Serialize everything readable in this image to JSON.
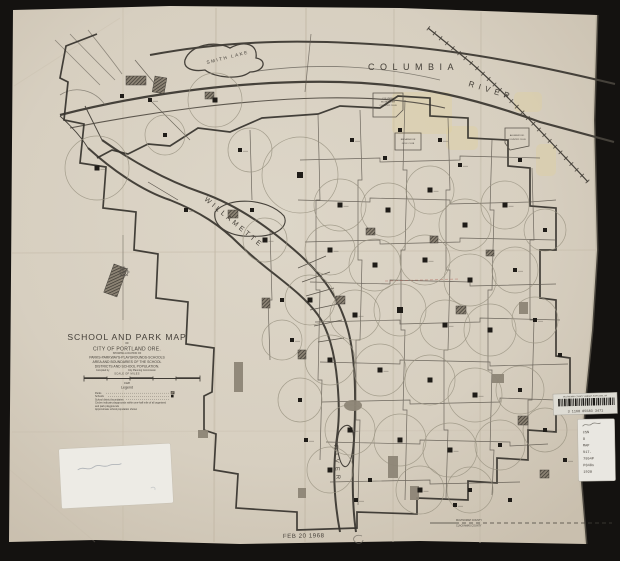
{
  "canvas": {
    "width": 620,
    "height": 561,
    "bg": "#141210",
    "paper": "#d8d0c2",
    "ink": "#433e37"
  },
  "map_labels": {
    "columbia": "COLUMBIA",
    "columbia_river": "RIVER",
    "smith_lake": "SMITH  LAKE",
    "willamette": "WILLAMETTE",
    "willamette_river": "RIVER",
    "club1": [
      "COLUMBIA",
      "EDGEWATER",
      "COUNTRY CLUB"
    ],
    "club2": [
      "BROADMOOR",
      "GOLF CLUB"
    ],
    "club3": [
      "ALDERWOOD",
      "COUNTRY CLUB"
    ],
    "county_top": "MULTNOMAH COUNTY",
    "county_bottom": "CLACKAMAS COUNTY"
  },
  "title_block": {
    "title": "SCHOOL AND PARK MAP",
    "of": "OF",
    "city": "CITY OF PORTLAND ORE.",
    "showing": "SHOWING LOCATION OF",
    "line1": "PARKS-PARKWAYS-PLAYGROUNDS-SCHOOLS",
    "line2": "AREA AND BOUNDARIES OF THE SCHOOL",
    "line3": "DISTRICTS AND SCHOOL POPULATION.",
    "compiled_by": "Compiled by",
    "commission": "City Planning Commission",
    "scale_caption": "SCALE OF MILES",
    "year": "1928",
    "legend_heading": "Legend",
    "legend_entries": [
      "Parks",
      "Schools",
      "School district boundaries",
      "Circles indicate playgrounds within one-half mile of all organized",
      "and park playgrounds",
      "Approximate school population shown"
    ]
  },
  "stamps": {
    "date": "FEB 20 1968"
  },
  "library": {
    "barcode_header": "MULTNOMAH COUNTY LIBRARY, PORTLAND, OR",
    "barcode_number": "3 1168 05583 3471",
    "call_lines": [
      "CSN",
      "O",
      "MAP",
      "917.",
      "7954P",
      "P848s",
      "1928"
    ]
  },
  "features": {
    "schools": [
      [
        97,
        168,
        5
      ],
      [
        122,
        96,
        4
      ],
      [
        150,
        100,
        4
      ],
      [
        165,
        135,
        4
      ],
      [
        186,
        210,
        4
      ],
      [
        215,
        100,
        5
      ],
      [
        240,
        150,
        4
      ],
      [
        252,
        210,
        4
      ],
      [
        265,
        240,
        5
      ],
      [
        282,
        300,
        4
      ],
      [
        292,
        340,
        4
      ],
      [
        300,
        400,
        4
      ],
      [
        306,
        440,
        4
      ],
      [
        330,
        470,
        5
      ],
      [
        356,
        500,
        4
      ],
      [
        300,
        175,
        6
      ],
      [
        340,
        205,
        5
      ],
      [
        388,
        210,
        5
      ],
      [
        430,
        190,
        5
      ],
      [
        465,
        225,
        5
      ],
      [
        505,
        205,
        5
      ],
      [
        545,
        230,
        4
      ],
      [
        330,
        250,
        5
      ],
      [
        375,
        265,
        5
      ],
      [
        425,
        260,
        5
      ],
      [
        470,
        280,
        5
      ],
      [
        515,
        270,
        4
      ],
      [
        310,
        300,
        5
      ],
      [
        355,
        315,
        5
      ],
      [
        400,
        310,
        6
      ],
      [
        445,
        325,
        5
      ],
      [
        490,
        330,
        5
      ],
      [
        535,
        320,
        4
      ],
      [
        330,
        360,
        5
      ],
      [
        380,
        370,
        5
      ],
      [
        430,
        380,
        5
      ],
      [
        475,
        395,
        5
      ],
      [
        520,
        390,
        4
      ],
      [
        350,
        430,
        5
      ],
      [
        400,
        440,
        5
      ],
      [
        450,
        450,
        5
      ],
      [
        500,
        445,
        4
      ],
      [
        545,
        430,
        4
      ],
      [
        370,
        480,
        4
      ],
      [
        420,
        490,
        5
      ],
      [
        470,
        490,
        4
      ],
      [
        440,
        140,
        4
      ],
      [
        400,
        130,
        4
      ],
      [
        352,
        140,
        4
      ],
      [
        560,
        355,
        4
      ],
      [
        565,
        460,
        4
      ],
      [
        510,
        500,
        4
      ],
      [
        455,
        505,
        4
      ],
      [
        385,
        158,
        4
      ],
      [
        460,
        165,
        4
      ],
      [
        520,
        160,
        4
      ]
    ],
    "circles": [
      [
        97,
        168,
        32
      ],
      [
        215,
        100,
        27
      ],
      [
        165,
        135,
        20
      ],
      [
        300,
        175,
        38
      ],
      [
        250,
        150,
        22
      ],
      [
        340,
        205,
        26
      ],
      [
        388,
        210,
        27
      ],
      [
        430,
        190,
        24
      ],
      [
        465,
        225,
        26
      ],
      [
        505,
        205,
        24
      ],
      [
        545,
        230,
        21
      ],
      [
        330,
        250,
        25
      ],
      [
        375,
        265,
        26
      ],
      [
        425,
        260,
        25
      ],
      [
        470,
        280,
        26
      ],
      [
        515,
        270,
        23
      ],
      [
        310,
        300,
        25
      ],
      [
        355,
        315,
        25
      ],
      [
        400,
        310,
        26
      ],
      [
        445,
        325,
        25
      ],
      [
        490,
        330,
        26
      ],
      [
        535,
        320,
        23
      ],
      [
        330,
        360,
        25
      ],
      [
        380,
        370,
        26
      ],
      [
        430,
        380,
        25
      ],
      [
        475,
        395,
        27
      ],
      [
        520,
        390,
        24
      ],
      [
        300,
        400,
        22
      ],
      [
        350,
        430,
        25
      ],
      [
        400,
        440,
        26
      ],
      [
        450,
        450,
        27
      ],
      [
        500,
        445,
        25
      ],
      [
        545,
        430,
        22
      ],
      [
        330,
        470,
        23
      ],
      [
        420,
        490,
        24
      ],
      [
        470,
        490,
        23
      ],
      [
        265,
        240,
        22
      ],
      [
        282,
        340,
        20
      ]
    ],
    "parks_hatched": [
      [
        126,
        76,
        20,
        9,
        0
      ],
      [
        155,
        76,
        12,
        16,
        10
      ],
      [
        114,
        264,
        14,
        30,
        20
      ],
      [
        228,
        210,
        10,
        8,
        0
      ],
      [
        262,
        298,
        8,
        10,
        0
      ],
      [
        336,
        296,
        9,
        8,
        0
      ],
      [
        456,
        306,
        10,
        8,
        0
      ],
      [
        298,
        350,
        8,
        9,
        0
      ],
      [
        518,
        416,
        10,
        9,
        0
      ],
      [
        366,
        228,
        9,
        7,
        0
      ],
      [
        430,
        236,
        8,
        7,
        0
      ],
      [
        486,
        250,
        8,
        6,
        0
      ],
      [
        205,
        92,
        9,
        7,
        0
      ],
      [
        540,
        470,
        9,
        8,
        0
      ]
    ],
    "parks_solid": [
      [
        234,
        362,
        9,
        30,
        "r"
      ],
      [
        344,
        400,
        18,
        11,
        "e"
      ],
      [
        388,
        456,
        10,
        22,
        "r"
      ],
      [
        410,
        486,
        9,
        14,
        "r"
      ],
      [
        492,
        374,
        12,
        9,
        "r"
      ],
      [
        519,
        302,
        9,
        12,
        "r"
      ],
      [
        198,
        430,
        10,
        8,
        "r"
      ],
      [
        298,
        488,
        8,
        10,
        "r"
      ]
    ],
    "patches": [
      [
        392,
        92,
        60,
        42
      ],
      [
        446,
        126,
        32,
        24
      ],
      [
        536,
        144,
        20,
        32
      ],
      [
        514,
        92,
        28,
        20
      ]
    ]
  }
}
